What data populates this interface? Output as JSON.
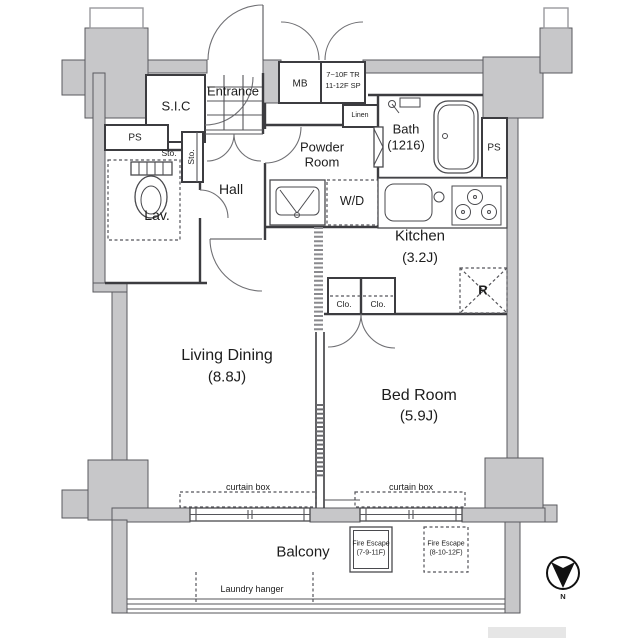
{
  "colors": {
    "wall_fill": "#c7c7c9",
    "wall_stroke": "#5a5a5e",
    "line": "#3c3c40",
    "text": "#1d1d1d"
  },
  "rooms": {
    "living": {
      "name": "Living Dining",
      "size": "(8.8J)"
    },
    "bedroom": {
      "name": "Bed Room",
      "size": "(5.9J)"
    },
    "kitchen": {
      "name": "Kitchen",
      "size": "(3.2J)"
    },
    "bath": {
      "name": "Bath",
      "size": "(1216)"
    },
    "powder": {
      "name": "Powder Room"
    },
    "hall": {
      "name": "Hall"
    },
    "lavatory": {
      "name": "Lav."
    },
    "entrance": {
      "name": "Entrance"
    },
    "shoe_closet": {
      "name": "S.I.C"
    },
    "balcony": {
      "name": "Balcony"
    }
  },
  "storage": {
    "linen": "Linen",
    "hall_storage": "Sto.",
    "toilet_storage": "Sto.",
    "closet_left": "Clo.",
    "closet_right": "Clo."
  },
  "utility": {
    "meter_box": "MB",
    "riser_note_line1": "7~10F TR",
    "riser_note_line2": "11-12F SP",
    "pipe_space_left": "PS",
    "pipe_space_right": "PS",
    "washer_dryer": "W/D",
    "refrigerator": "R"
  },
  "annotations": {
    "curtain_box_living": "curtain box",
    "curtain_box_bedroom": "curtain box",
    "laundry_hanger": "Laundry hanger",
    "fire_escape_left": {
      "label": "Fire Escape",
      "floors": "(7-9-11F)"
    },
    "fire_escape_right": {
      "label": "Fire Escape",
      "floors": "(8-10-12F)"
    },
    "compass_north": "N"
  }
}
